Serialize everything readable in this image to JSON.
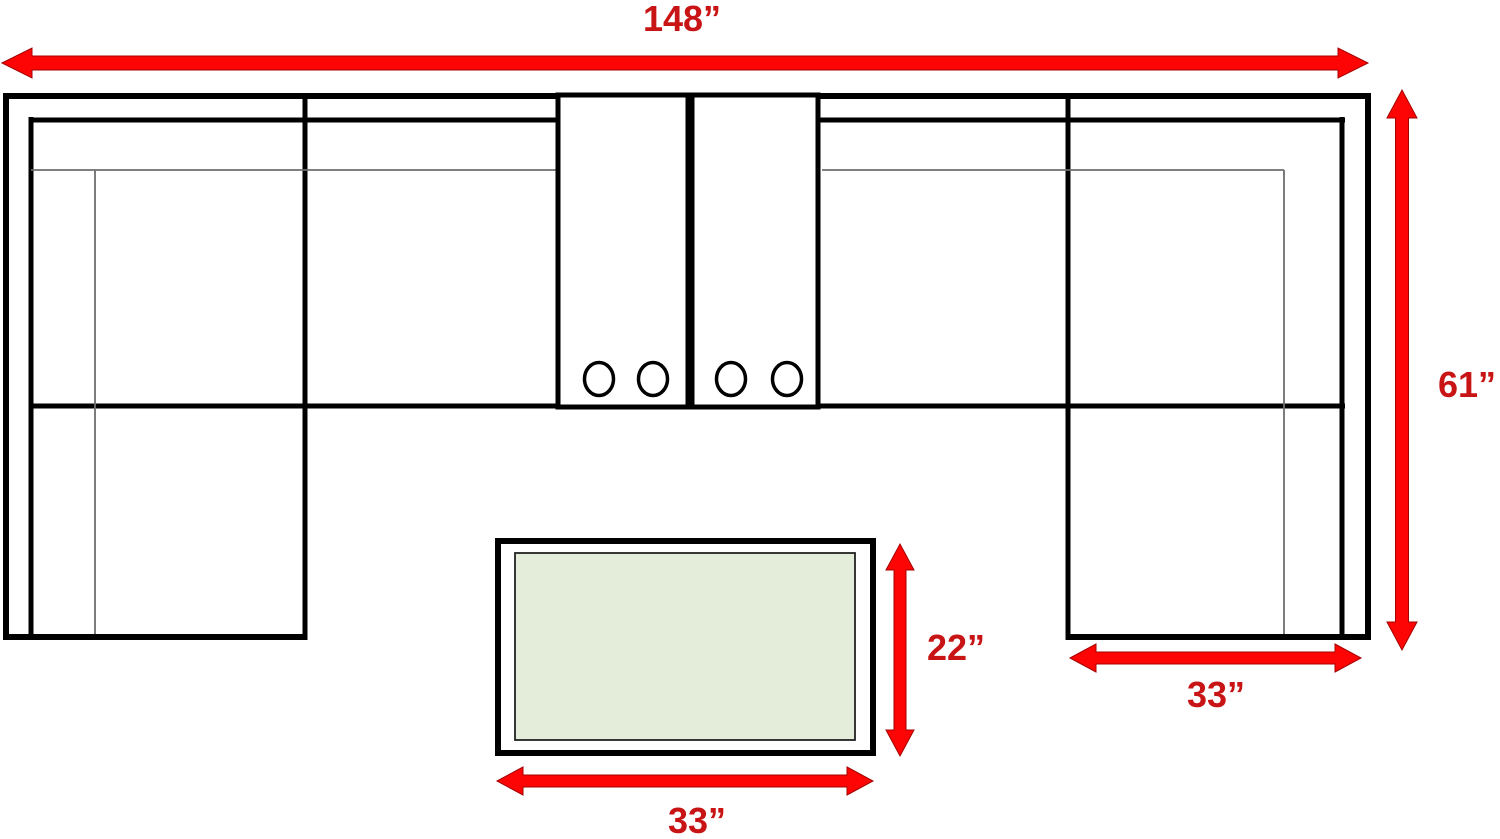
{
  "diagram": {
    "type": "sectional-sofa-dimension-plan",
    "background": "#ffffff",
    "colors": {
      "outline": "#000000",
      "seam_gray": "#6e6e6e",
      "arrow_fill": "#fe0505",
      "arrow_stroke": "#a40000",
      "label_red": "#c81414",
      "ottoman_top_fill": "#e4ecda"
    },
    "dimensions": [
      {
        "id": "overall-width",
        "label": "148”",
        "orientation": "horizontal"
      },
      {
        "id": "overall-depth",
        "label": "61”",
        "orientation": "vertical"
      },
      {
        "id": "ottoman-depth",
        "label": "22”",
        "orientation": "vertical"
      },
      {
        "id": "ottoman-width",
        "label": "33”",
        "orientation": "horizontal"
      },
      {
        "id": "right-chaise-width",
        "label": "33”",
        "orientation": "horizontal"
      }
    ],
    "features": {
      "console_count": 2,
      "cup_holder_count": 4,
      "pieces": [
        "left-chaise",
        "left-seat",
        "console-1",
        "console-2",
        "right-seat",
        "right-chaise",
        "ottoman"
      ]
    }
  }
}
